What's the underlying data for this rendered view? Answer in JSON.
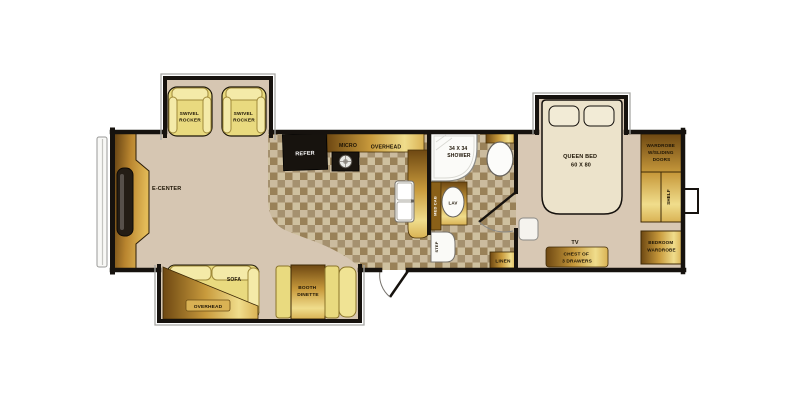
{
  "colors": {
    "wall": "#16120e",
    "carpet": "#d6c6b2",
    "tile_light": "#cbbb9e",
    "tile_dark": "#a5916f",
    "gold_dark": "#6e4812",
    "gold_light": "#f0dd8c",
    "furniture_yellow": "#e9da7f",
    "appliance_black": "#17130e",
    "bed_cream": "#ece3cb",
    "fixture_white": "#fbfbf8"
  },
  "floorplan": {
    "living": {
      "e_center": "E-CENTER",
      "swivel_rocker": [
        "SWIVEL",
        "ROCKER"
      ],
      "sofa": "SOFA",
      "overhead": "OVERHEAD",
      "booth_dinette": [
        "BOOTH",
        "DINETTE"
      ]
    },
    "kitchen": {
      "refer": "REFER",
      "micro": "MICRO",
      "overhead": "OVERHEAD"
    },
    "bath": {
      "shower": [
        "34 X 34",
        "SHOWER"
      ],
      "med_cab": "MED CAB",
      "lav": "LAV",
      "step": "STEP",
      "linen": "LINEN"
    },
    "bedroom": {
      "queen_bed": [
        "QUEEN BED",
        "60 X 80"
      ],
      "tv": "TV",
      "chest": [
        "CHEST OF",
        "3 DRAWERS"
      ],
      "wardrobe_sliding": [
        "WARDROBE",
        "W/SLIDING",
        "DOORS"
      ],
      "shelf": "SHELF",
      "bedroom_wardrobe": [
        "BEDROOM",
        "WARDROBE"
      ]
    }
  }
}
